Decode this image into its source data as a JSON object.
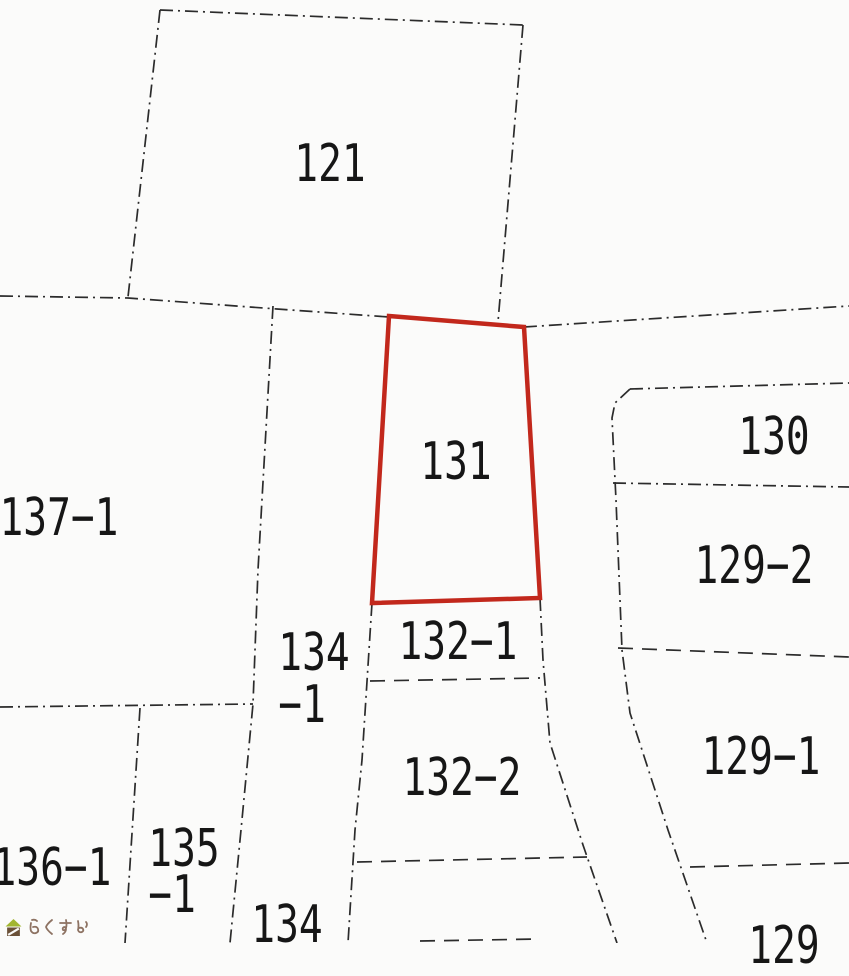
{
  "app": {
    "type": "cadastral-parcel-map",
    "background_color": "#fbfbfa",
    "boundary_line_color": "#2b2b2b"
  },
  "map": {
    "highlight": {
      "parcel": "131",
      "outline_color": "#c2281c"
    },
    "parcels": [
      {
        "id": "121",
        "label": "121"
      },
      {
        "id": "131",
        "label": "131",
        "highlighted": "true"
      },
      {
        "id": "137-1",
        "label": "137−1"
      },
      {
        "id": "130",
        "label": "130"
      },
      {
        "id": "129-2",
        "label": "129−2"
      },
      {
        "id": "129-1",
        "label": "129−1"
      },
      {
        "id": "132-1",
        "label": "132−1"
      },
      {
        "id": "132-2",
        "label": "132−2"
      },
      {
        "id": "134-1",
        "label": "134",
        "label2": "−1"
      },
      {
        "id": "136-1",
        "label": "136−1"
      },
      {
        "id": "135-1",
        "label": "135",
        "label2": "−1"
      },
      {
        "id": "134",
        "label": "134"
      },
      {
        "id": "129",
        "label": "129"
      }
    ]
  },
  "logo": {
    "text": "らくすむ",
    "icon": "house-icon",
    "text_color": "#8d7262",
    "roof_color": "#a2b531",
    "body_color": "#6b5138"
  }
}
